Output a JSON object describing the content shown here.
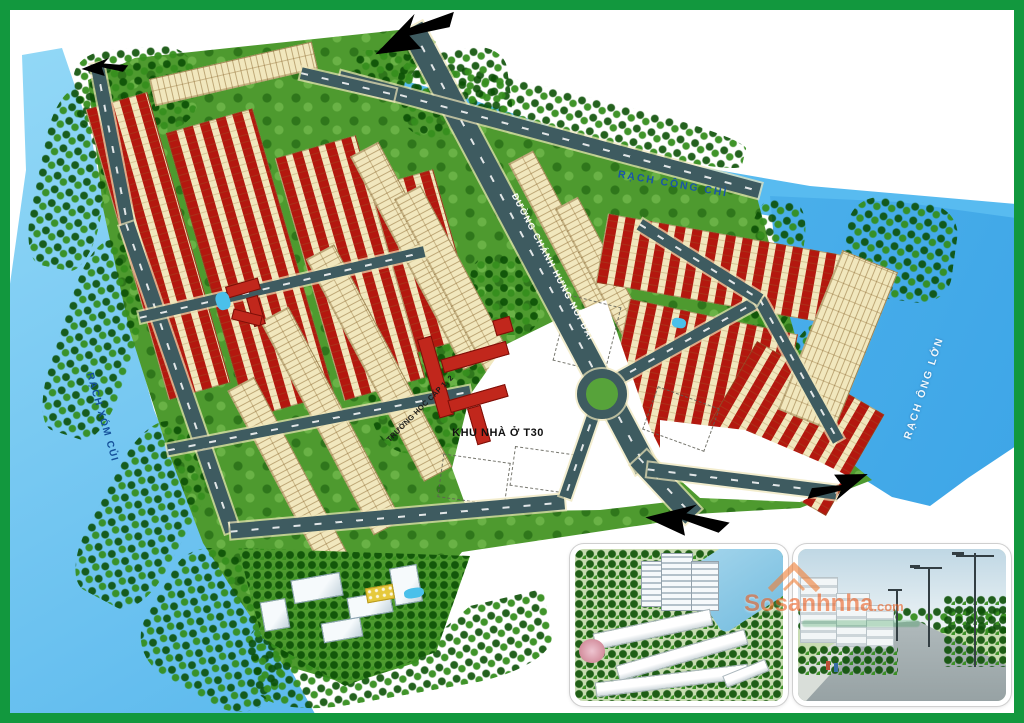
{
  "plan": {
    "water_labels": {
      "top": "RẠCH CÔNG CHÌ",
      "right": "RẠCH ÔNG LỚN",
      "left": "RẠCH XÓM CỦI"
    },
    "road_label": "ĐƯỜNG CHÁNH HƯNG NỐI DÀI",
    "area_labels": {
      "t30": "KHU NHÀ Ở T30",
      "school": "TRƯỜNG HỌC CẤP 1, 2"
    },
    "colors": {
      "water": "#52b7ee",
      "land_green": "#4e9a2f",
      "road_gray": "#3e5b60",
      "lot_cream": "#f1e7bd",
      "villa_roof_red": "#b3180f",
      "school_red": "#c1271c",
      "frame_green": "#12983e"
    }
  },
  "watermark": {
    "brand": "Sosanhnha",
    "tld": ".com"
  },
  "icons": {
    "arrows": "road-direction-arrow",
    "watermark_icon": "house-roof-icon"
  }
}
